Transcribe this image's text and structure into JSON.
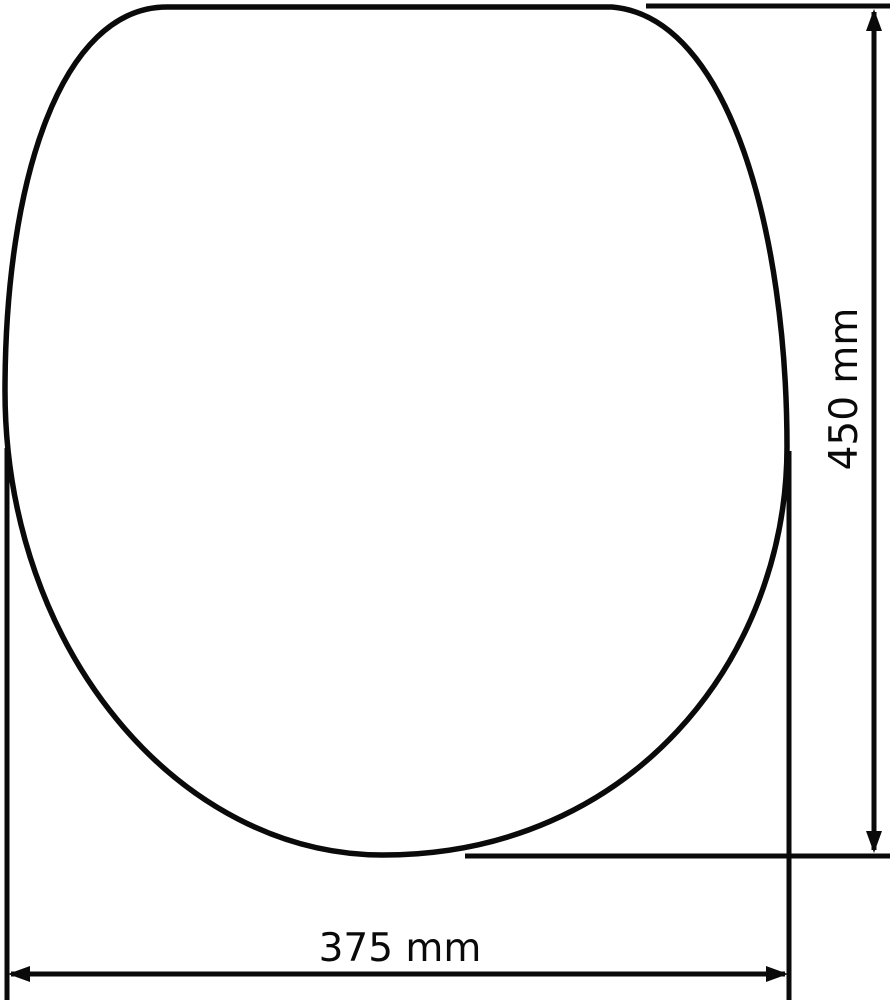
{
  "diagram": {
    "background_color": "#ffffff",
    "stroke_color": "#0a0a0a",
    "dimensions": {
      "height": {
        "label": "450 mm",
        "value": 450,
        "unit": "mm",
        "placement": "vertical-right"
      },
      "width": {
        "label": "375 mm",
        "value": 375,
        "unit": "mm",
        "placement": "horizontal-bottom"
      }
    }
  }
}
